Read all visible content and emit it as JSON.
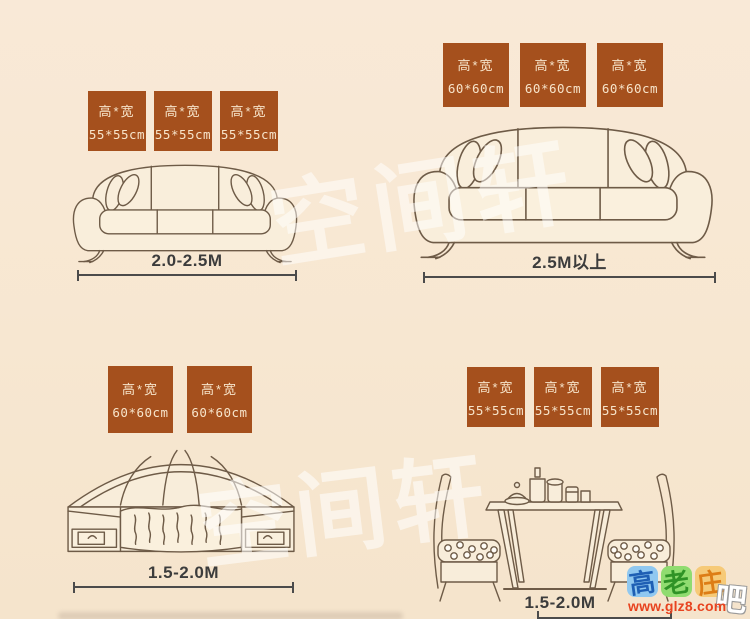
{
  "watermarks": {
    "top_text": "空间轩",
    "bottom_text": "空间轩"
  },
  "panels": [
    {
      "name": "small-sofa",
      "tags": [
        {
          "line1": "高*宽",
          "line2": "55*55cm"
        },
        {
          "line1": "高*宽",
          "line2": "55*55cm"
        },
        {
          "line1": "高*宽",
          "line2": "55*55cm"
        }
      ],
      "size_label": "2.0-2.5M"
    },
    {
      "name": "large-sofa",
      "tags": [
        {
          "line1": "高*宽",
          "line2": "60*60cm"
        },
        {
          "line1": "高*宽",
          "line2": "60*60cm"
        },
        {
          "line1": "高*宽",
          "line2": "60*60cm"
        }
      ],
      "size_label": "2.5M以上"
    },
    {
      "name": "bed",
      "tags": [
        {
          "line1": "高*宽",
          "line2": "60*60cm"
        },
        {
          "line1": "高*宽",
          "line2": "60*60cm"
        }
      ],
      "size_label": "1.5-2.0M"
    },
    {
      "name": "dining-set",
      "tags": [
        {
          "line1": "高*宽",
          "line2": "55*55cm"
        },
        {
          "line1": "高*宽",
          "line2": "55*55cm"
        },
        {
          "line1": "高*宽",
          "line2": "55*55cm"
        }
      ],
      "size_label": "1.5-2.0M"
    }
  ],
  "site_badge": {
    "characters": [
      {
        "char": "高",
        "bg": "#90c8f0",
        "fg": "#1e5fb4"
      },
      {
        "char": "老",
        "bg": "#90dc70",
        "fg": "#2f9326"
      },
      {
        "char": "庄",
        "bg": "#f6ca78",
        "fg": "#dd7d16"
      }
    ],
    "suffix": "吧",
    "url": "www.glz8.com",
    "url_color": "#e8431f"
  },
  "colors": {
    "background": "#f8e8d3",
    "tag_background": "#a5501d",
    "tag_text": "#f7e4ca",
    "line_art": "#6e5b47",
    "measure": "#4b4b4b"
  }
}
